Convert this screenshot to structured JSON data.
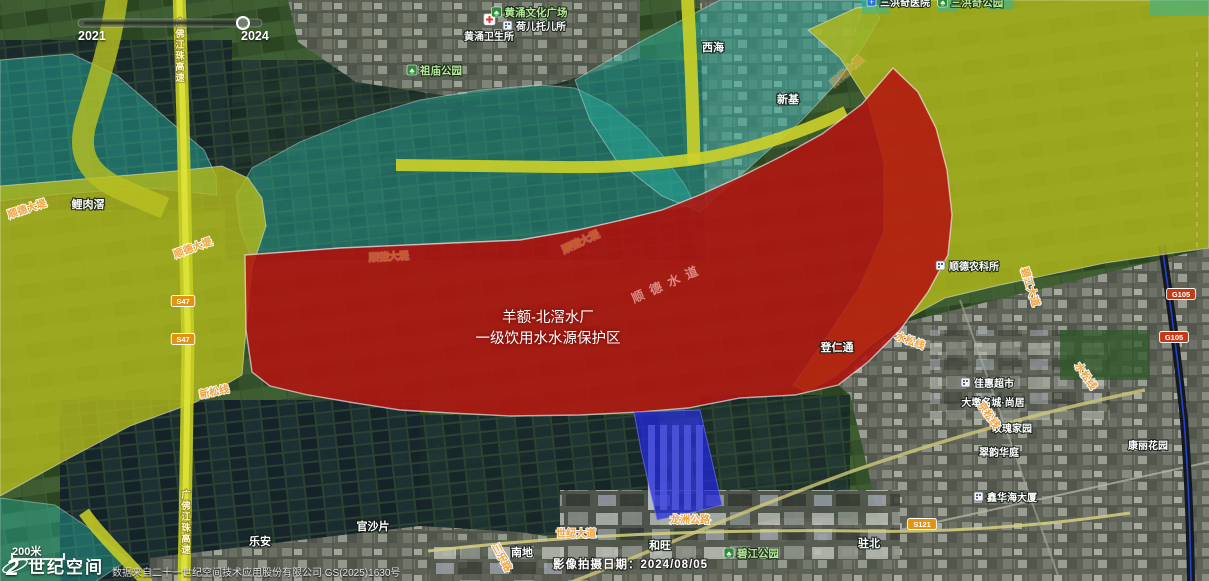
{
  "app": {
    "logo_mark": "2",
    "logo_text": "世纪空间",
    "scale_label": "200米",
    "attribution": "数据来自二十一世纪空间技术应用股份有限公司 GS(2025)1630号",
    "capture_date_label": "影像拍摄日期：2024/08/05"
  },
  "timeline": {
    "start_year": "2021",
    "end_year": "2024"
  },
  "protection_zone": {
    "line1": "羊额-北滘水厂",
    "line2": "一级饮用水水源保护区"
  },
  "colors": {
    "zone_level1_red": "#b31410",
    "river_zone_olive": "#b4bb1c",
    "secondary_zone_teal": "#28b8a8",
    "water_plant_blue": "#2127e0",
    "road_label_orange": "#f2a33c"
  },
  "map_labels": [
    {
      "text": "鲤肉滘",
      "x": 88,
      "y": 208,
      "cls": "place"
    },
    {
      "text": "西海",
      "x": 713,
      "y": 51,
      "cls": "place"
    },
    {
      "text": "新基",
      "x": 788,
      "y": 103,
      "cls": "place"
    },
    {
      "text": "乐安",
      "x": 260,
      "y": 545,
      "cls": "place"
    },
    {
      "text": "官沙片",
      "x": 373,
      "y": 530,
      "cls": "place"
    },
    {
      "text": "南地",
      "x": 522,
      "y": 556,
      "cls": "place"
    },
    {
      "text": "和旺",
      "x": 660,
      "y": 549,
      "cls": "place"
    },
    {
      "text": "驻北",
      "x": 869,
      "y": 547,
      "cls": "place"
    },
    {
      "text": "登仁通",
      "x": 837,
      "y": 351,
      "cls": "place"
    },
    {
      "text": "大墩名城·尚居",
      "x": 993,
      "y": 406,
      "cls": "place-sm"
    },
    {
      "text": "玫瑰家园",
      "x": 1012,
      "y": 432,
      "cls": "place-sm"
    },
    {
      "text": "翠韵华庭",
      "x": 999,
      "y": 456,
      "cls": "place-sm"
    },
    {
      "text": "康丽花园",
      "x": 1148,
      "y": 449,
      "cls": "place-sm"
    },
    {
      "text": "佳惠超市",
      "x": 994,
      "y": 387,
      "cls": "place-sm",
      "icon": "building"
    },
    {
      "text": "鑫华海大厦",
      "x": 1012,
      "y": 501,
      "cls": "place-sm",
      "icon": "building"
    },
    {
      "text": "顺德农科所",
      "x": 974,
      "y": 270,
      "cls": "place-sm",
      "icon": "building"
    },
    {
      "text": "黄涌卫生所",
      "x": 489,
      "y": 40,
      "cls": "place-sm",
      "icon": "cross",
      "icon_pos": "above"
    },
    {
      "text": "荷儿托儿所",
      "x": 541,
      "y": 30,
      "cls": "place-sm",
      "icon": "building"
    },
    {
      "text": "三洪奇医院",
      "x": 905,
      "y": 6,
      "cls": "place-sm",
      "icon": "hospital"
    },
    {
      "text": "黄涌文化广场",
      "x": 536,
      "y": 16,
      "cls": "poi-green",
      "icon": "tree"
    },
    {
      "text": "祖庙公园",
      "x": 441,
      "y": 74,
      "cls": "poi-green",
      "icon": "tree"
    },
    {
      "text": "碧江公园",
      "x": 758,
      "y": 557,
      "cls": "poi-green",
      "icon": "tree"
    },
    {
      "text": "三洪奇公园",
      "x": 977,
      "y": 6,
      "cls": "poi-green",
      "icon": "tree"
    },
    {
      "text": "顺德大堤",
      "x": 28,
      "y": 212,
      "cls": "road",
      "rot": -18
    },
    {
      "text": "顺德大堤",
      "x": 194,
      "y": 251,
      "cls": "road",
      "rot": -20
    },
    {
      "text": "世纪大道",
      "x": 576,
      "y": 537,
      "cls": "road"
    },
    {
      "text": "龙洲公路",
      "x": 690,
      "y": 523,
      "cls": "road"
    },
    {
      "text": "水松线",
      "x": 909,
      "y": 344,
      "cls": "road",
      "rot": 20
    },
    {
      "text": "水松线",
      "x": 1083,
      "y": 378,
      "cls": "road",
      "rot": 55
    },
    {
      "text": "京松线",
      "x": 986,
      "y": 417,
      "cls": "road",
      "rot": 55
    },
    {
      "text": "新松线",
      "x": 215,
      "y": 395,
      "cls": "road",
      "rot": -12
    },
    {
      "text": "碧江大道",
      "x": 1027,
      "y": 288,
      "cls": "road",
      "rot": 72
    },
    {
      "text": "三乐路",
      "x": 499,
      "y": 559,
      "cls": "road",
      "rot": 62
    },
    {
      "text": "顺德大堤",
      "x": 389,
      "y": 260,
      "cls": "road-faint",
      "rot": -3
    },
    {
      "text": "顺德大堤",
      "x": 582,
      "y": 245,
      "cls": "road-faint",
      "rot": -25
    },
    {
      "text": "顺德大堤",
      "x": 849,
      "y": 74,
      "cls": "road-faint",
      "rot": -42
    },
    {
      "text": "广佛江珠高速",
      "x": 180,
      "y": 26,
      "cls": "road-v",
      "vertical": true
    },
    {
      "text": "广佛江珠高速",
      "x": 186,
      "y": 498,
      "cls": "road-v",
      "vertical": true
    },
    {
      "text": "顺德水道",
      "x": 634,
      "y": 303,
      "cls": "river",
      "rot": -24
    }
  ],
  "road_shields": [
    {
      "label": "S47",
      "x": 183,
      "y": 301,
      "type": "provincial"
    },
    {
      "label": "S47",
      "x": 183,
      "y": 339,
      "type": "provincial"
    },
    {
      "label": "G105",
      "x": 1181,
      "y": 294,
      "type": "national"
    },
    {
      "label": "G105",
      "x": 1174,
      "y": 337,
      "type": "national"
    },
    {
      "label": "S121",
      "x": 922,
      "y": 524,
      "type": "provincial"
    }
  ]
}
